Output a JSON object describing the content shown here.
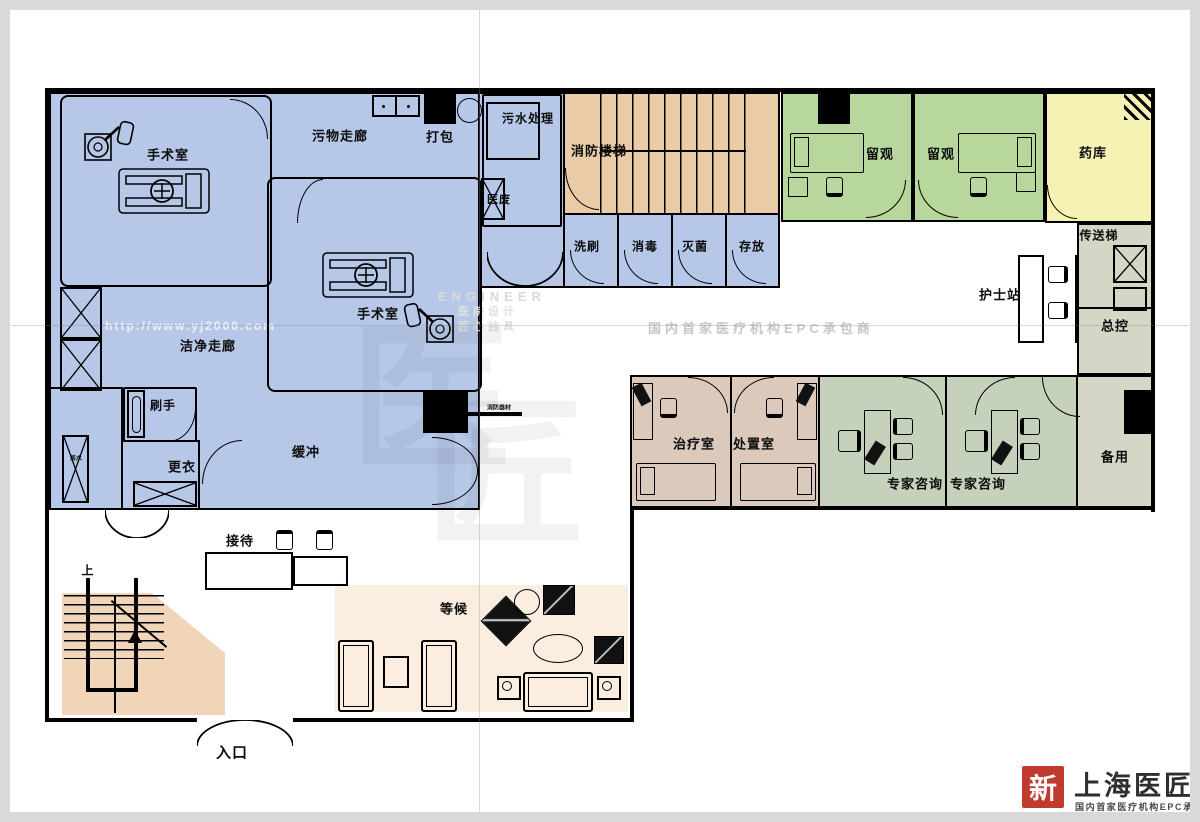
{
  "colors": {
    "surgical_blue": "#b6c7e8",
    "fire_stairs_tan": "#e9cba8",
    "lobby_stairs_tan": "#f0d5b8",
    "waiting_cream": "#fbeee0",
    "observation_green": "#b7d79c",
    "pharmacy_yellow": "#f6f2b3",
    "utility_gray": "#d4d6c6",
    "treatment_brown": "#dbc9bb",
    "consult_sage": "#c5d1bb",
    "wall_black": "#000000",
    "logo_red": "#bf3b2d"
  },
  "rooms": {
    "or1": "手术室",
    "or2": "手术室",
    "dirty_corridor": "污物走廊",
    "packing": "打包",
    "sewage": "污水处理",
    "medical_waste": "医废",
    "fire_stairs": "消防楼梯",
    "wash": "洗刷",
    "disinfect": "消毒",
    "sterilize": "灭菌",
    "store": "存放",
    "clean_corridor": "洁净走廊",
    "scrub": "刷手",
    "changing": "更衣",
    "buffer": "缓冲",
    "tea": "茶水",
    "obs1": "留观",
    "obs2": "留观",
    "pharmacy": "药库",
    "dumbwaiter": "传送梯",
    "nurse_station": "护士站",
    "master_control": "总控",
    "spare": "备用",
    "treatment": "治疗室",
    "disposal": "处置室",
    "consult1": "专家咨询",
    "consult2": "专家咨询",
    "reception": "接待",
    "waiting": "等候",
    "entrance": "入口",
    "stairs_up": "上",
    "fire_equipment": "消防器材"
  },
  "watermarks": {
    "url": "http://www.yj2000.com",
    "epc": "国内首家医疗机构EPC承包商",
    "engineer": "ENGINEER",
    "tagline1": "医院设计",
    "tagline2": "匠心独具",
    "seal1": "医",
    "seal2": "匠"
  },
  "logo": {
    "seal": "新",
    "name": "上海医匠",
    "tagline": "国内首家医疗机构EPC承包商"
  }
}
